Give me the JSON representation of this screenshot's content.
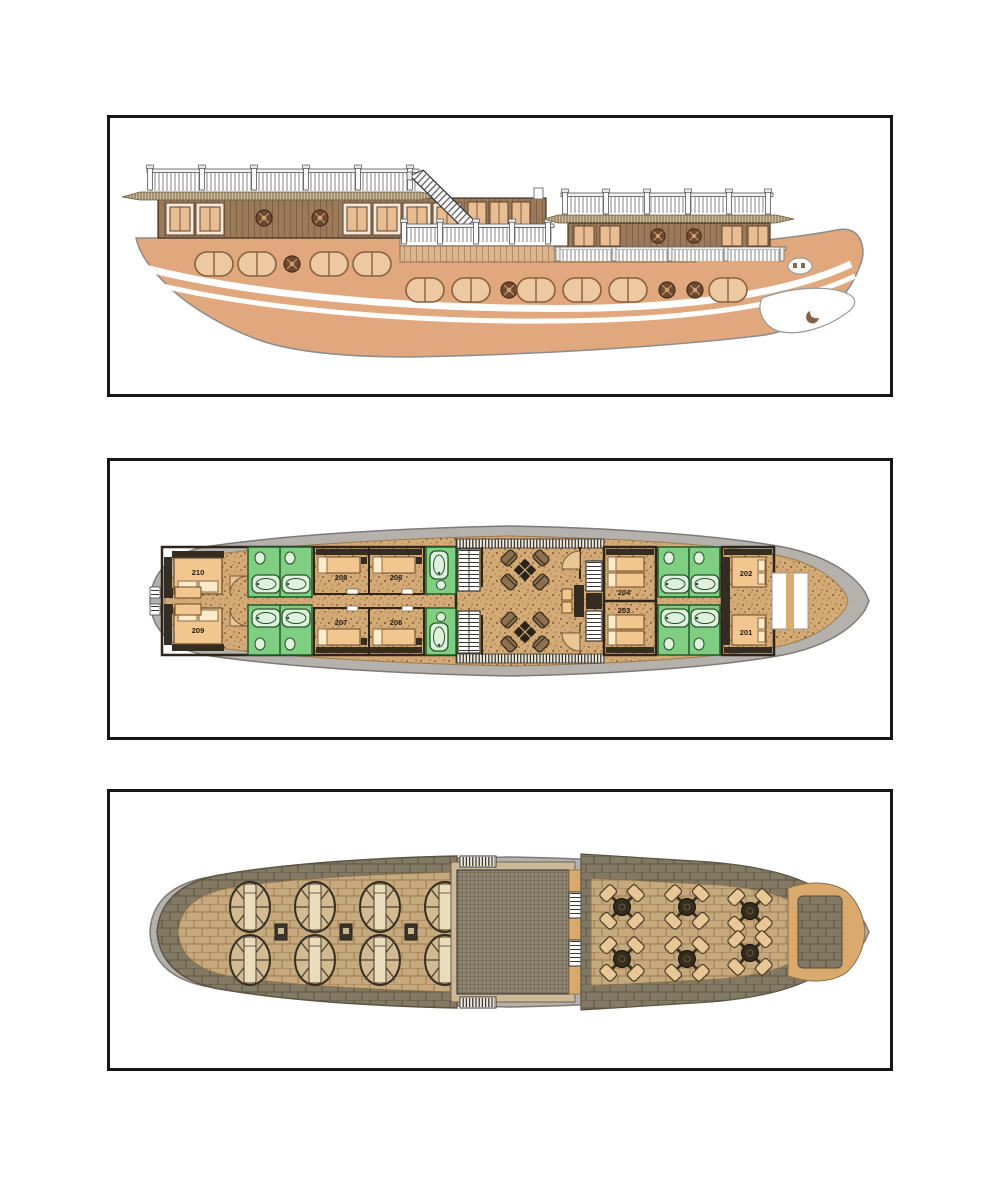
{
  "colors": {
    "page-bg": "#FFFFFF",
    "panel-border": "#161616",
    "hull-peach": "#E1A87E",
    "wood-brown": "#9B7A5B",
    "window-tan": "#EBC49B",
    "deck-speckle-tan": "#D4AB76",
    "bathroom-green": "#7FCE82",
    "bed-tan": "#F1C78F",
    "wall-dark": "#352C22",
    "hull-gray": "#B5B1AD",
    "deck-brick-dark": "#837A64",
    "deck-brick-light": "#C7A97E",
    "bow-tan": "#D9A96E"
  },
  "panels": {
    "side_elevation": {
      "view": "boat-side-elevation"
    },
    "cabin_deck": {
      "view": "cabin-deck-plan",
      "port_cabins": [
        "210",
        "208",
        "206",
        "204",
        "202"
      ],
      "starboard_cabins": [
        "209",
        "207",
        "205",
        "203",
        "201"
      ]
    },
    "sun_deck": {
      "view": "sun-deck-plan",
      "sun_loungers": 8,
      "dining_tables": 6
    }
  }
}
